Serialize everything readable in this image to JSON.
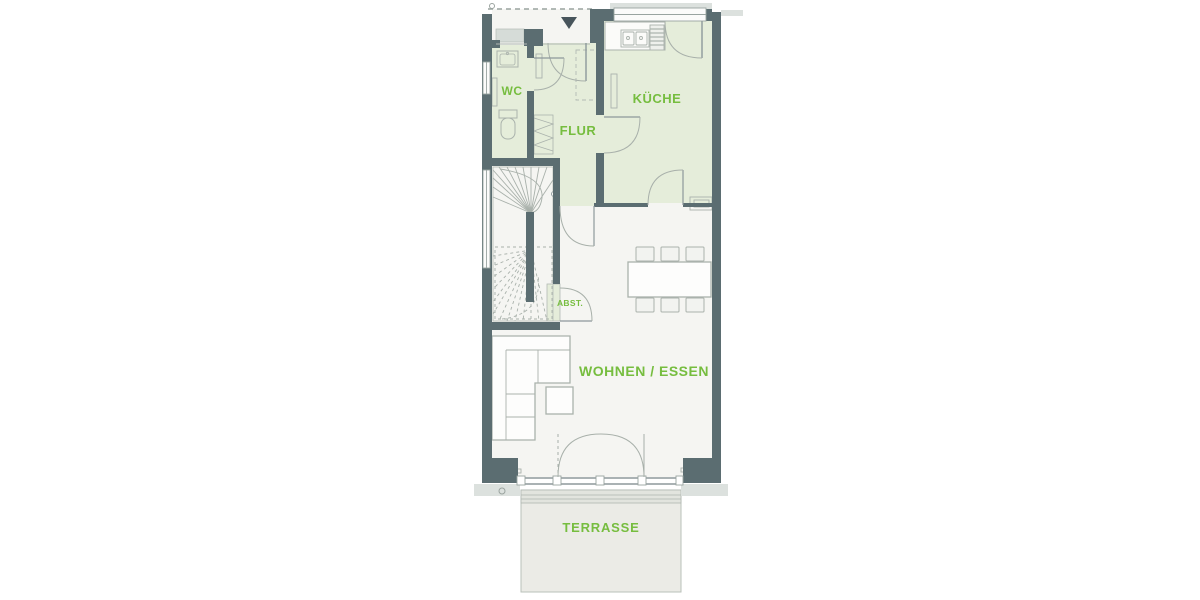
{
  "plan": {
    "type": "ground-floor-plan",
    "rooms": {
      "wc": {
        "label": "WC"
      },
      "flur": {
        "label": "FLUR"
      },
      "kueche": {
        "label": "KÜCHE"
      },
      "abst": {
        "label": "ABST."
      },
      "wohnen_essen": {
        "label": "WOHNEN / ESSEN"
      },
      "terrasse": {
        "label": "TERRASSE"
      }
    },
    "icons": {
      "entrance_marker": "triangle-down"
    },
    "colors": {
      "wall": "#5b6d71",
      "wall_dark": "#47545b",
      "room_tint": "#e5edda",
      "floor": "#f5f5f2",
      "terrace": "#ebebe6",
      "terrace_step": "#e2e4de",
      "sill_gray": "#dce1de",
      "mat_gray": "#d6dcd8",
      "label_green": "#76bd3f",
      "furniture_line": "#aab2ac",
      "door_line": "#9aa5a1"
    }
  }
}
